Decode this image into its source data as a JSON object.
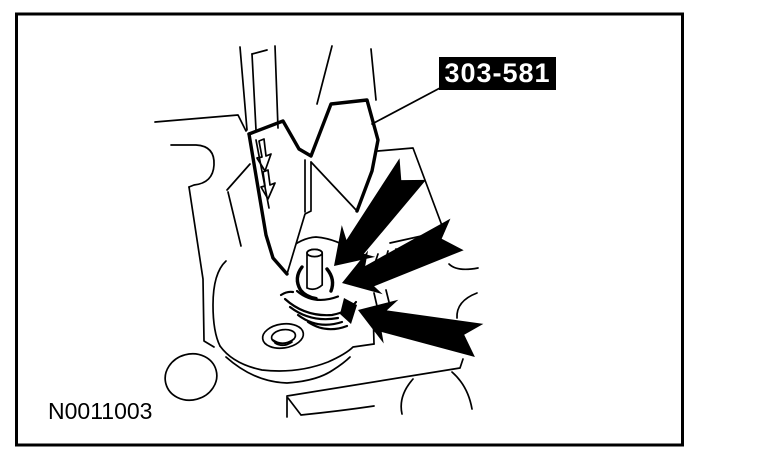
{
  "figure": {
    "background_color": "#ffffff",
    "line_color": "#000000",
    "tool_callout": {
      "text": "303-581",
      "bg_color": "#000000",
      "text_color": "#ffffff"
    },
    "figure_number": "N0011003",
    "icons": [
      {
        "name": "indicator-arrow-top"
      },
      {
        "name": "indicator-arrow-middle"
      },
      {
        "name": "indicator-arrow-bottom"
      }
    ]
  }
}
